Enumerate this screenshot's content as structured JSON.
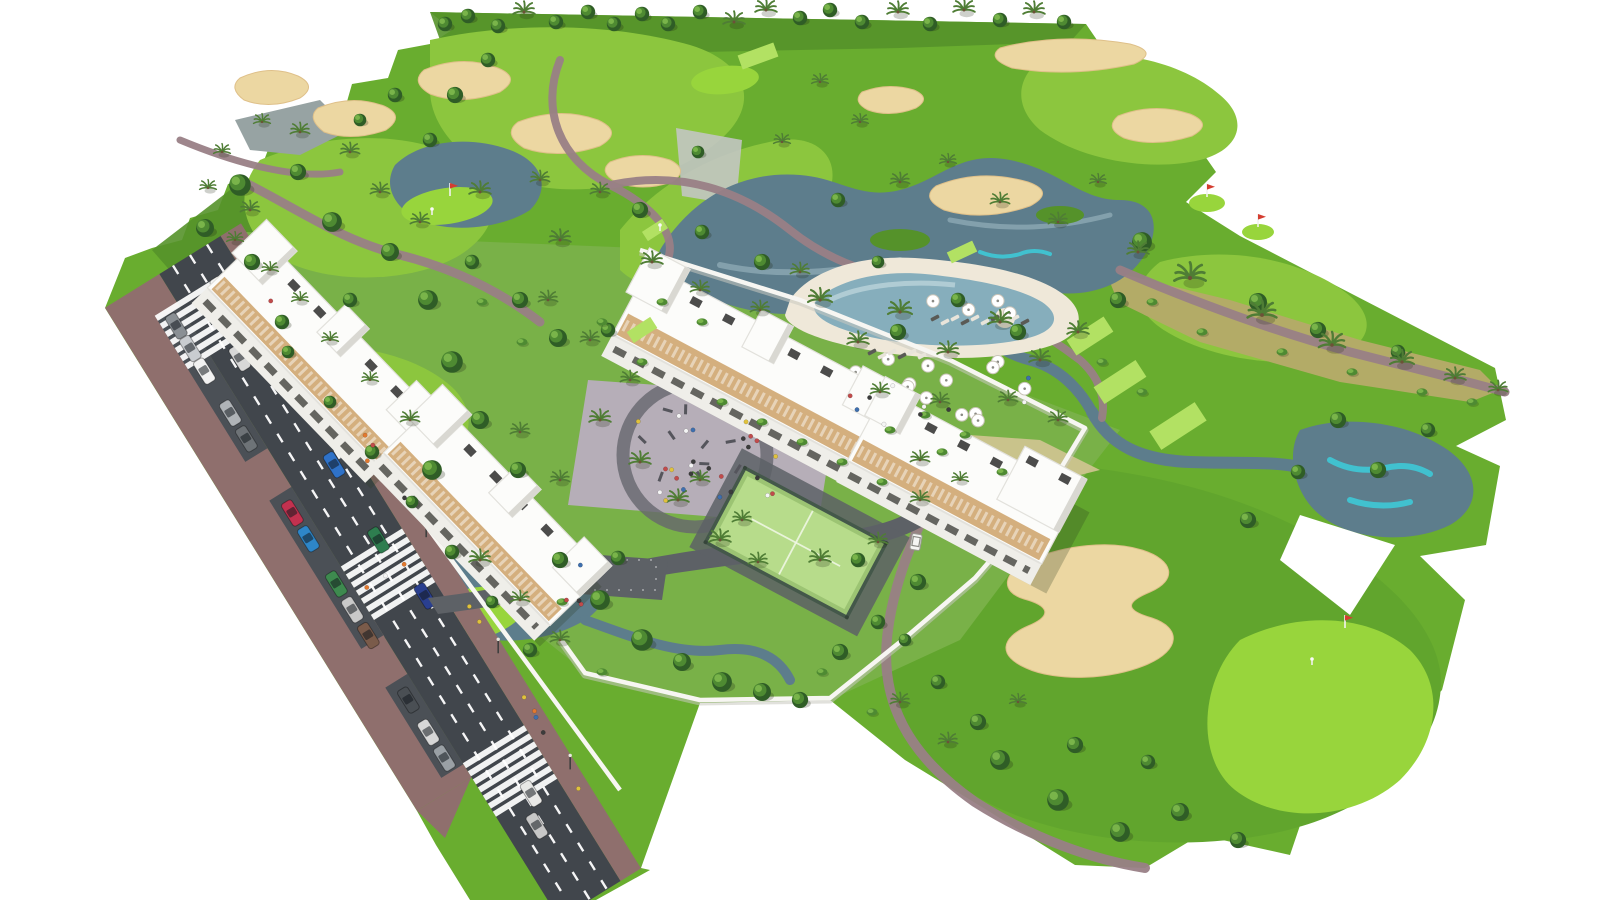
{
  "meta": {
    "description": "Aerial 3D rendering of a white low-rise apartment complex beside a golf course: diagonal avenue with parked cars and zebra crossings, communal pool with umbrellas, playground plaza, padel court, golf fairways, ponds with turquoise accents, sand bunkers, putting greens with flags, cart paths, palms and trees on a white background",
    "width_px": 1600,
    "height_px": 900
  },
  "palette": {
    "bg": "#ffffff",
    "grassBase": "#69ad2f",
    "grassRough": "#55922a",
    "grassComplex": "#79b148",
    "fairway": "#8cc63e",
    "fairwayDeep": "#61a52d",
    "green": "#98d53c",
    "tee": "#b2e163",
    "scrub": "#b3ab67",
    "dry": "#d2c592",
    "grayPond": "#97a3a3",
    "sand": "#ecd7a2",
    "sandDark": "#dfc089",
    "waterDark": "#5d7d8c",
    "waterMid": "#7796a3",
    "waterLight": "#a3bdc6",
    "cyan": "#3ec9d6",
    "pathMauve": "#997f86",
    "pathGray": "#b5afb8",
    "asphalt": "#41464c",
    "asphaltLight": "#5d6166",
    "roadLine": "#ffffff",
    "sidewalk": "#8f6f6d",
    "bay": "#4b5056",
    "wall": "#f7f6f2",
    "wallShadow": "#c9c8c0",
    "bldg": "#fcfcfa",
    "bldgEdge": "#e2e1dc",
    "bldgShade": "#d9d8d2",
    "facade": "#efeee9",
    "windowDark": "#4c4c48",
    "wood": "#d0a873",
    "woodDark": "#b9905c",
    "plaza": "#b6aeb8",
    "plazaRing": "#66666e",
    "padel": "#b7dc8b",
    "padeldk": "#9cc473",
    "fence": "#44584a",
    "poolWater": "#86aebc",
    "poolLight": "#c2d8de",
    "poolDeck": "#efe8d9",
    "treeDark": "#2f5d26",
    "treeMid": "#4e8a32",
    "treeLight": "#79b44a",
    "palm": "#4f7d35",
    "trunk": "#6d5138",
    "grayStruct": "#c2c5c2",
    "flagRed": "#d43d30",
    "cart": "#f5f5f2"
  },
  "road": {
    "start": [
      190,
      255
    ],
    "end": [
      590,
      900
    ],
    "asphalt_half_width": 36,
    "lane_dashes_offsets": [
      -20,
      0,
      20
    ],
    "crosswalks": [
      {
        "t": 0.085,
        "from": -62,
        "to": 36
      },
      {
        "t": 0.495,
        "from": -36,
        "to": 36
      },
      {
        "t": 0.8,
        "from": -36,
        "to": 36
      }
    ],
    "cars_driving": [
      {
        "t": 0.06,
        "d": 8,
        "color": "#f4f4f2"
      },
      {
        "t": 0.15,
        "d": -12,
        "color": "#d8d8d8"
      },
      {
        "t": 0.335,
        "d": 12,
        "color": "#2f72c8"
      },
      {
        "t": 0.45,
        "d": 10,
        "color": "#2e7d4f"
      },
      {
        "t": 0.545,
        "d": 20,
        "color": "#2a3f8f"
      },
      {
        "t": 0.84,
        "d": 6,
        "color": "#e8e8e6"
      },
      {
        "t": 0.88,
        "d": -6,
        "color": "#c7c7c7"
      }
    ],
    "cars_parked": [
      {
        "t": 0.07,
        "color": "#8a8f94"
      },
      {
        "t": 0.105,
        "color": "#c9ccd0"
      },
      {
        "t": 0.14,
        "color": "#f2f2f2"
      },
      {
        "t": 0.205,
        "color": "#b0b4b8"
      },
      {
        "t": 0.245,
        "color": "#6e7377"
      },
      {
        "t": 0.36,
        "color": "#c2314f"
      },
      {
        "t": 0.4,
        "color": "#2e86c8"
      },
      {
        "t": 0.47,
        "color": "#3e8a4f"
      },
      {
        "t": 0.51,
        "color": "#c9c9c9"
      },
      {
        "t": 0.55,
        "color": "#7a5b4a"
      },
      {
        "t": 0.65,
        "color": "#4a4f54"
      },
      {
        "t": 0.7,
        "color": "#d7d7d7"
      },
      {
        "t": 0.74,
        "color": "#9aa0a5"
      }
    ],
    "parked_offset": -49,
    "lamps_t": [
      0.12,
      0.3,
      0.48,
      0.66,
      0.84
    ]
  },
  "golf": {
    "tees": [
      [
        1090,
        336,
        44,
        18,
        -33
      ],
      [
        1120,
        382,
        50,
        20,
        -33
      ],
      [
        1178,
        426,
        54,
        22,
        -33
      ],
      [
        642,
        330,
        28,
        13,
        -33
      ],
      [
        655,
        230,
        24,
        11,
        -33
      ],
      [
        758,
        56,
        38,
        15,
        -20
      ],
      [
        962,
        252,
        28,
        12,
        -25
      ]
    ],
    "flags": [
      [
        450,
        196
      ],
      [
        1207,
        197
      ],
      [
        1258,
        227
      ],
      [
        1345,
        628
      ]
    ],
    "golfers": [
      [
        432,
        212
      ],
      [
        1312,
        662
      ],
      [
        660,
        228
      ]
    ],
    "cart": {
      "x": 916,
      "y": 542,
      "rot": 100
    },
    "bunkers_count": 11,
    "ponds_count": 6,
    "greens_count": 6
  },
  "vegetation": {
    "horizon": [
      [
        445,
        24,
        "d"
      ],
      [
        468,
        16,
        "d"
      ],
      [
        498,
        26,
        "d"
      ],
      [
        524,
        12,
        "p"
      ],
      [
        556,
        22,
        "d"
      ],
      [
        588,
        12,
        "d"
      ],
      [
        614,
        24,
        "d"
      ],
      [
        642,
        14,
        "d"
      ],
      [
        668,
        24,
        "d"
      ],
      [
        700,
        12,
        "d"
      ],
      [
        734,
        22,
        "p"
      ],
      [
        766,
        10,
        "p"
      ],
      [
        800,
        18,
        "d"
      ],
      [
        830,
        10,
        "d"
      ],
      [
        862,
        22,
        "d"
      ],
      [
        898,
        12,
        "p"
      ],
      [
        930,
        24,
        "d"
      ],
      [
        964,
        10,
        "p"
      ],
      [
        1000,
        20,
        "d"
      ],
      [
        1034,
        12,
        "p"
      ],
      [
        1064,
        22,
        "d"
      ]
    ],
    "deciduous": [
      [
        240,
        185,
        1.2
      ],
      [
        205,
        228,
        1.0
      ],
      [
        298,
        172,
        0.9
      ],
      [
        332,
        222,
        1.1
      ],
      [
        390,
        252,
        1.0
      ],
      [
        428,
        300,
        1.1
      ],
      [
        472,
        262,
        0.8
      ],
      [
        520,
        300,
        0.9
      ],
      [
        558,
        338,
        1.0
      ],
      [
        608,
        330,
        0.8
      ],
      [
        452,
        362,
        1.2
      ],
      [
        480,
        420,
        1.0
      ],
      [
        432,
        470,
        1.1
      ],
      [
        518,
        470,
        0.9
      ],
      [
        252,
        262,
        0.9
      ],
      [
        282,
        322,
        0.8
      ],
      [
        350,
        300,
        0.8
      ],
      [
        640,
        210,
        0.9
      ],
      [
        702,
        232,
        0.8
      ],
      [
        762,
        262,
        0.9
      ],
      [
        698,
        152,
        0.7
      ],
      [
        838,
        200,
        0.8
      ],
      [
        878,
        262,
        0.7
      ],
      [
        958,
        300,
        0.8
      ],
      [
        1018,
        332,
        0.9
      ],
      [
        898,
        332,
        0.9
      ],
      [
        1142,
        242,
        1.1
      ],
      [
        1118,
        300,
        0.9
      ],
      [
        1258,
        302,
        1.0
      ],
      [
        1318,
        330,
        0.9
      ],
      [
        1398,
        352,
        0.8
      ],
      [
        1338,
        420,
        0.9
      ],
      [
        1428,
        430,
        0.8
      ],
      [
        1378,
        470,
        0.9
      ],
      [
        1298,
        472,
        0.8
      ],
      [
        1248,
        520,
        0.9
      ],
      [
        1000,
        760,
        1.1
      ],
      [
        1058,
        800,
        1.2
      ],
      [
        1120,
        832,
        1.1
      ],
      [
        1180,
        812,
        1.0
      ],
      [
        1238,
        840,
        0.9
      ],
      [
        1148,
        762,
        0.8
      ],
      [
        978,
        722,
        0.9
      ],
      [
        938,
        682,
        0.8
      ],
      [
        600,
        600,
        1.1
      ],
      [
        642,
        640,
        1.2
      ],
      [
        682,
        662,
        1.0
      ],
      [
        722,
        682,
        1.1
      ],
      [
        762,
        692,
        1.0
      ],
      [
        800,
        700,
        0.9
      ],
      [
        560,
        560,
        0.9
      ],
      [
        618,
        558,
        0.8
      ],
      [
        840,
        652,
        0.9
      ],
      [
        878,
        622,
        0.8
      ],
      [
        918,
        582,
        0.9
      ],
      [
        858,
        560,
        0.8
      ],
      [
        288,
        352,
        0.7
      ],
      [
        330,
        402,
        0.7
      ],
      [
        372,
        452,
        0.8
      ],
      [
        412,
        502,
        0.7
      ],
      [
        452,
        552,
        0.8
      ],
      [
        492,
        602,
        0.7
      ],
      [
        530,
        650,
        0.8
      ],
      [
        1075,
        745,
        0.9
      ],
      [
        905,
        640,
        0.7
      ],
      [
        455,
        95,
        0.9
      ],
      [
        488,
        60,
        0.8
      ],
      [
        430,
        140,
        0.8
      ],
      [
        360,
        120,
        0.7
      ],
      [
        395,
        95,
        0.8
      ]
    ],
    "palms": [
      [
        820,
        300,
        1.0
      ],
      [
        858,
        342,
        0.9
      ],
      [
        900,
        312,
        1.0
      ],
      [
        948,
        352,
        0.9
      ],
      [
        1000,
        322,
        1.0
      ],
      [
        1040,
        360,
        0.9
      ],
      [
        1078,
        332,
        0.9
      ],
      [
        880,
        392,
        0.8
      ],
      [
        940,
        402,
        0.8
      ],
      [
        1008,
        400,
        0.8
      ],
      [
        1058,
        420,
        0.8
      ],
      [
        600,
        420,
        0.9
      ],
      [
        640,
        462,
        0.9
      ],
      [
        678,
        500,
        0.9
      ],
      [
        560,
        480,
        0.8
      ],
      [
        520,
        432,
        0.8
      ],
      [
        720,
        540,
        0.9
      ],
      [
        758,
        562,
        0.8
      ],
      [
        700,
        480,
        0.8
      ],
      [
        742,
        520,
        0.8
      ],
      [
        820,
        560,
        0.9
      ],
      [
        878,
        542,
        0.8
      ],
      [
        920,
        500,
        0.8
      ],
      [
        1190,
        278,
        1.3
      ],
      [
        1262,
        315,
        1.2
      ],
      [
        1332,
        345,
        1.1
      ],
      [
        1402,
        362,
        1.0
      ],
      [
        1455,
        378,
        0.9
      ],
      [
        1498,
        390,
        0.8
      ],
      [
        652,
        262,
        0.9
      ],
      [
        700,
        290,
        0.8
      ],
      [
        760,
        310,
        0.8
      ],
      [
        800,
        272,
        0.8
      ],
      [
        560,
        240,
        0.9
      ],
      [
        600,
        192,
        0.8
      ],
      [
        540,
        180,
        0.8
      ],
      [
        480,
        192,
        0.9
      ],
      [
        420,
        222,
        0.8
      ],
      [
        380,
        192,
        0.8
      ],
      [
        350,
        152,
        0.8
      ],
      [
        300,
        132,
        0.8
      ],
      [
        262,
        122,
        0.7
      ],
      [
        222,
        152,
        0.7
      ],
      [
        900,
        182,
        0.8
      ],
      [
        948,
        162,
        0.7
      ],
      [
        1000,
        202,
        0.8
      ],
      [
        1058,
        222,
        0.8
      ],
      [
        1098,
        182,
        0.7
      ],
      [
        860,
        122,
        0.7
      ],
      [
        820,
        82,
        0.7
      ],
      [
        782,
        142,
        0.7
      ],
      [
        900,
        702,
        0.8
      ],
      [
        948,
        742,
        0.8
      ],
      [
        1018,
        702,
        0.7
      ],
      [
        1138,
        252,
        0.9
      ],
      [
        250,
        210,
        0.8
      ],
      [
        208,
        188,
        0.7
      ],
      [
        548,
        300,
        0.8
      ],
      [
        590,
        340,
        0.8
      ],
      [
        630,
        380,
        0.8
      ],
      [
        480,
        560,
        0.9
      ],
      [
        520,
        600,
        0.8
      ],
      [
        560,
        640,
        0.8
      ],
      [
        920,
        460,
        0.8
      ],
      [
        960,
        480,
        0.7
      ],
      [
        410,
        420,
        0.8
      ],
      [
        370,
        380,
        0.7
      ],
      [
        330,
        340,
        0.7
      ],
      [
        300,
        300,
        0.7
      ],
      [
        270,
        270,
        0.7
      ],
      [
        235,
        240,
        0.7
      ]
    ],
    "bushes": [
      [
        1152,
        302
      ],
      [
        1202,
        332
      ],
      [
        1282,
        352
      ],
      [
        1352,
        372
      ],
      [
        1422,
        392
      ],
      [
        1472,
        402
      ],
      [
        662,
        302
      ],
      [
        702,
        322
      ],
      [
        482,
        302
      ],
      [
        522,
        342
      ],
      [
        562,
        602
      ],
      [
        882,
        482
      ],
      [
        942,
        452
      ],
      [
        1002,
        472
      ],
      [
        762,
        422
      ],
      [
        802,
        442
      ],
      [
        842,
        462
      ],
      [
        722,
        402
      ],
      [
        642,
        362
      ],
      [
        602,
        322
      ],
      [
        1102,
        362
      ],
      [
        1142,
        392
      ],
      [
        872,
        712
      ],
      [
        822,
        672
      ],
      [
        602,
        672
      ],
      [
        925,
        415
      ],
      [
        965,
        435
      ],
      [
        890,
        430
      ]
    ]
  },
  "amenities": {
    "umbrella_regions": [
      {
        "cx": 930,
        "cy": 388,
        "rx": 138,
        "ry": 40,
        "n": 15
      },
      {
        "cx": 985,
        "cy": 300,
        "rx": 58,
        "ry": 16,
        "n": 4
      }
    ],
    "lounger_rows": [
      {
        "cx": 985,
        "cy": 318,
        "n": 10,
        "rot": -28
      },
      {
        "cx": 902,
        "cy": 352,
        "n": 6,
        "rot": -28
      }
    ],
    "playground": {
      "cx": 690,
      "cy": 452,
      "r": 66,
      "n": 10
    },
    "people_regions": [
      {
        "cx": 700,
        "cy": 458,
        "rx": 100,
        "ry": 52,
        "n": 26
      },
      {
        "cx": 940,
        "cy": 395,
        "rx": 115,
        "ry": 36,
        "n": 10
      },
      {
        "cx": 560,
        "cy": 585,
        "rx": 40,
        "ry": 25,
        "n": 4
      }
    ],
    "road_people": {
      "n": 12,
      "tmin": 0.05,
      "tmax": 0.88,
      "dmin": 42,
      "dmax": 56
    },
    "crossing_people": {
      "t": 0.495,
      "n": 3
    },
    "people_colors": [
      "#e2792f",
      "#f5f5f5",
      "#3e6fae",
      "#c14b4b",
      "#3c3c3c",
      "#e0c23c"
    ]
  },
  "complex": {
    "building_blocks": 2,
    "building_segments": 4,
    "stair_towers": 6,
    "features": [
      "pool",
      "padel-court",
      "playground-plaza",
      "residents-parking",
      "perimeter-wall",
      "garage-entrance"
    ]
  }
}
